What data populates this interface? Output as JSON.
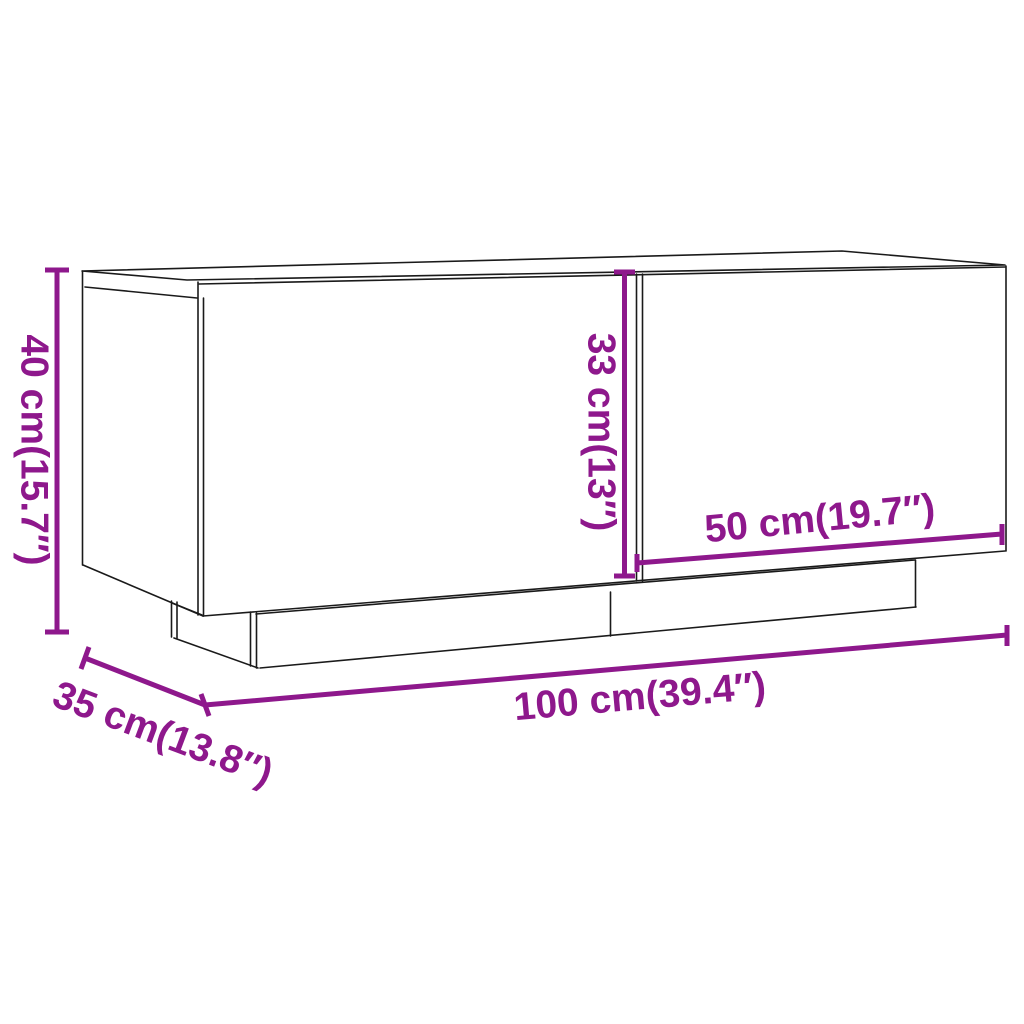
{
  "title": "TV cabinet dimension diagram",
  "colors": {
    "dimension_accent": "#8E188C",
    "outline": "#1A1A1A",
    "background": "#FFFFFF"
  },
  "dimensions": {
    "height": {
      "label": "40 cm(15.7″)"
    },
    "depth": {
      "label": "35 cm(13.8″)"
    },
    "width": {
      "label": "100 cm(39.4″)"
    },
    "inner_height": {
      "label": "33 cm(13″)"
    },
    "door_width": {
      "label": "50 cm(19.7″)"
    }
  }
}
